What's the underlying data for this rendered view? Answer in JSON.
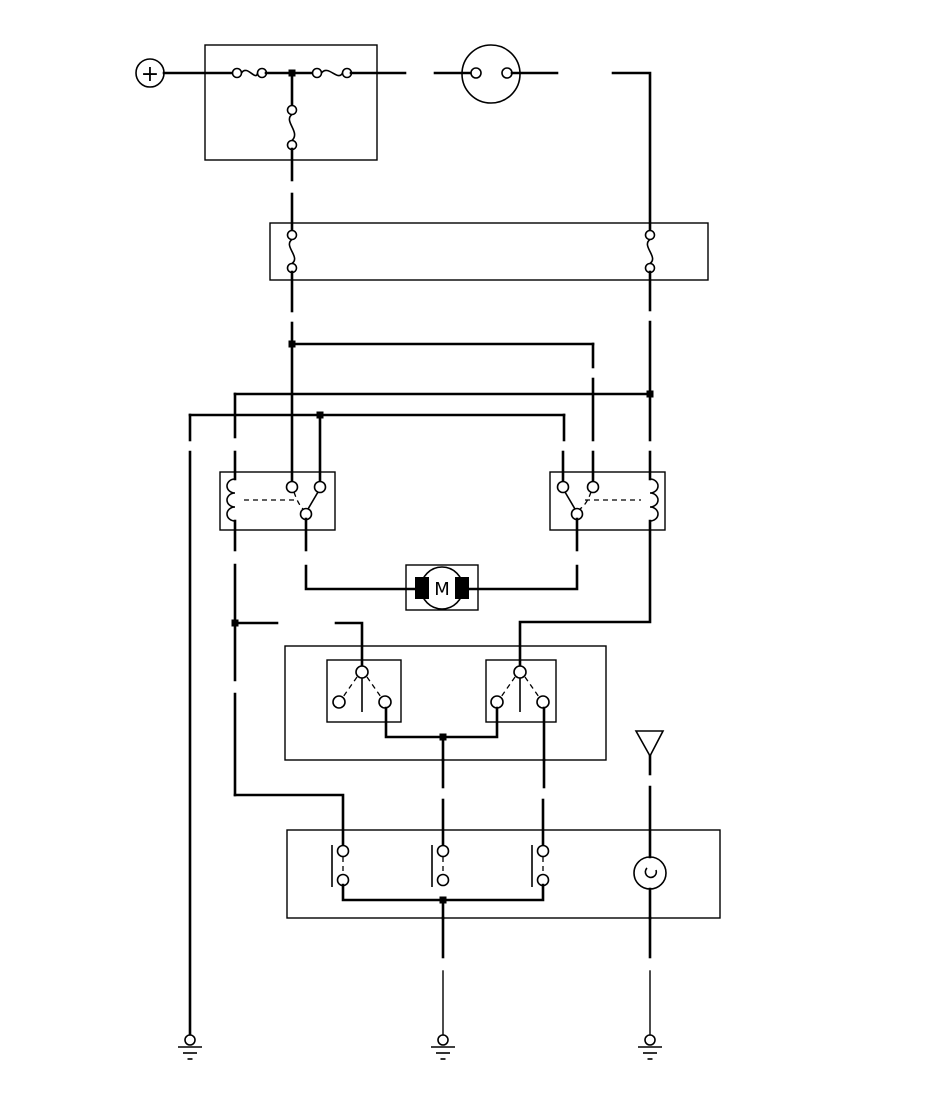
{
  "diagram": {
    "kind": "automotive-wiring-diagram",
    "theme": {
      "line_color": "#000000",
      "background_color": "#ffffff"
    },
    "labels": {
      "battery_plus": "+",
      "motor": "M"
    },
    "components": [
      {
        "name": "battery-positive-terminal",
        "symbol": "circle-with-plus"
      },
      {
        "name": "engine-compartment-fuse-box",
        "symbol": "box-with-three-fuses"
      },
      {
        "name": "ignition-switch",
        "symbol": "circle-with-two-terminals"
      },
      {
        "name": "dash-fuse-box",
        "symbol": "box-with-two-fuses"
      },
      {
        "name": "relay-left",
        "symbol": "coil-with-changeover-contact"
      },
      {
        "name": "relay-right",
        "symbol": "coil-with-changeover-contact"
      },
      {
        "name": "motor",
        "symbol": "circle-M-with-brushes"
      },
      {
        "name": "control-switch-unit",
        "symbol": "box-with-two-multi-position-switches"
      },
      {
        "name": "antenna-symbol",
        "symbol": "inverted-triangle"
      },
      {
        "name": "switch-panel-unit",
        "symbol": "box-with-three-pushbutton-switches-and-bulb"
      },
      {
        "name": "bulb",
        "symbol": "circle-with-filament"
      },
      {
        "name": "ground-left",
        "symbol": "earth-ground"
      },
      {
        "name": "ground-center",
        "symbol": "earth-ground"
      },
      {
        "name": "ground-right",
        "symbol": "earth-ground"
      }
    ]
  }
}
